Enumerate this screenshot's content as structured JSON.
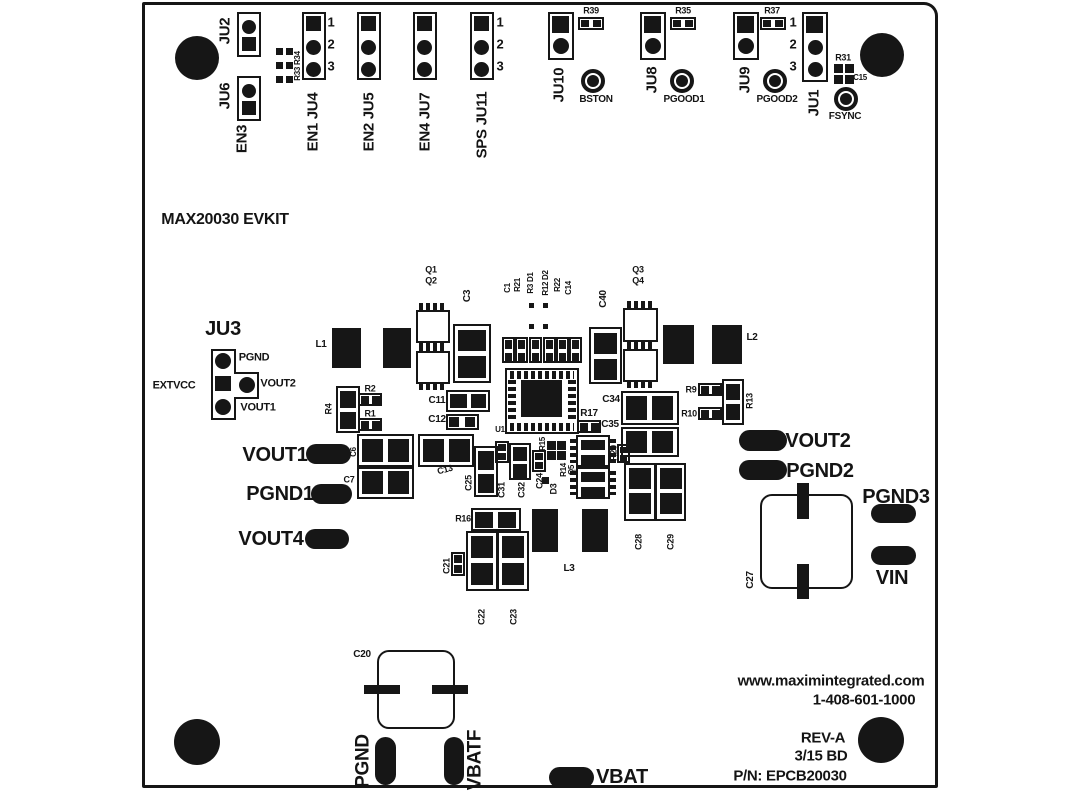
{
  "meta": {
    "title": "MAX20030 EVKIT",
    "part_number": "EPCB20030",
    "revision": "REV-A",
    "silkscreen_color": "#161616",
    "board_color": "#ffffff"
  },
  "labels": [
    {
      "n": "label-ju2",
      "t": "JU2",
      "x": 225,
      "y": 31,
      "s": 15,
      "r": -90
    },
    {
      "n": "label-ju6",
      "t": "JU6",
      "x": 225,
      "y": 96,
      "s": 15,
      "r": -90
    },
    {
      "n": "label-en3",
      "t": "EN3",
      "x": 242,
      "y": 139,
      "s": 15,
      "r": -90
    },
    {
      "n": "label-r33-r34",
      "t": "R33 R34",
      "x": 298,
      "y": 66,
      "s": 8,
      "r": -90
    },
    {
      "n": "label-ju4",
      "t": "EN1 JU4",
      "x": 313,
      "y": 122,
      "s": 15,
      "r": -90
    },
    {
      "n": "label-ju5",
      "t": "EN2 JU5",
      "x": 369,
      "y": 122,
      "s": 15,
      "r": -90
    },
    {
      "n": "label-ju7",
      "t": "EN4 JU7",
      "x": 425,
      "y": 122,
      "s": 15,
      "r": -90
    },
    {
      "n": "label-ju11",
      "t": "SPS JU11",
      "x": 482,
      "y": 125,
      "s": 15,
      "r": -90
    },
    {
      "n": "label-ju4-pin1",
      "t": "1",
      "x": 331,
      "y": 22,
      "s": 13
    },
    {
      "n": "label-ju4-pin2",
      "t": "2",
      "x": 331,
      "y": 44,
      "s": 13
    },
    {
      "n": "label-ju4-pin3",
      "t": "3",
      "x": 331,
      "y": 66,
      "s": 13
    },
    {
      "n": "label-ju11-pin1",
      "t": "1",
      "x": 500,
      "y": 22,
      "s": 13
    },
    {
      "n": "label-ju11-pin2",
      "t": "2",
      "x": 500,
      "y": 44,
      "s": 13
    },
    {
      "n": "label-ju11-pin3",
      "t": "3",
      "x": 500,
      "y": 66,
      "s": 13
    },
    {
      "n": "label-ju10",
      "t": "JU10",
      "x": 559,
      "y": 85,
      "s": 15,
      "r": -90
    },
    {
      "n": "label-r39",
      "t": "R39",
      "x": 591,
      "y": 11,
      "s": 9
    },
    {
      "n": "label-bston",
      "t": "BSTON",
      "x": 596,
      "y": 100,
      "s": 10
    },
    {
      "n": "label-ju8",
      "t": "JU8",
      "x": 652,
      "y": 80,
      "s": 15,
      "r": -90
    },
    {
      "n": "label-r35",
      "t": "R35",
      "x": 683,
      "y": 11,
      "s": 9
    },
    {
      "n": "label-pgood1",
      "t": "PGOOD1",
      "x": 684,
      "y": 100,
      "s": 10
    },
    {
      "n": "label-ju9",
      "t": "JU9",
      "x": 745,
      "y": 80,
      "s": 15,
      "r": -90
    },
    {
      "n": "label-r37",
      "t": "R37",
      "x": 772,
      "y": 11,
      "s": 9
    },
    {
      "n": "label-pgood2",
      "t": "PGOOD2",
      "x": 777,
      "y": 100,
      "s": 10
    },
    {
      "n": "label-ju1",
      "t": "JU1",
      "x": 814,
      "y": 103,
      "s": 15,
      "r": -90
    },
    {
      "n": "label-ju1-pin1",
      "t": "1",
      "x": 793,
      "y": 22,
      "s": 13
    },
    {
      "n": "label-ju1-pin2",
      "t": "2",
      "x": 793,
      "y": 44,
      "s": 13
    },
    {
      "n": "label-ju1-pin3",
      "t": "3",
      "x": 793,
      "y": 66,
      "s": 13
    },
    {
      "n": "label-r31",
      "t": "R31",
      "x": 843,
      "y": 58,
      "s": 9
    },
    {
      "n": "label-c15",
      "t": "C15",
      "x": 860,
      "y": 78,
      "s": 8
    },
    {
      "n": "label-fsync",
      "t": "FSYNC",
      "x": 845,
      "y": 117,
      "s": 10
    },
    {
      "n": "board-title",
      "t": "MAX20030 EVKIT",
      "x": 225,
      "y": 220,
      "s": 16
    },
    {
      "n": "label-ju3",
      "t": "JU3",
      "x": 223,
      "y": 329,
      "s": 20
    },
    {
      "n": "label-ju3-pgnd",
      "t": "PGND",
      "x": 254,
      "y": 358,
      "s": 11
    },
    {
      "n": "label-ju3-vout2",
      "t": "VOUT2",
      "x": 278,
      "y": 384,
      "s": 11
    },
    {
      "n": "label-ju3-vout1",
      "t": "VOUT1",
      "x": 258,
      "y": 408,
      "s": 11
    },
    {
      "n": "label-extvcc",
      "t": "EXTVCC",
      "x": 174,
      "y": 386,
      "s": 11
    },
    {
      "n": "label-l1",
      "t": "L1",
      "x": 321,
      "y": 345,
      "s": 10
    },
    {
      "n": "label-q1",
      "t": "Q1",
      "x": 431,
      "y": 270,
      "s": 9
    },
    {
      "n": "label-q2",
      "t": "Q2",
      "x": 431,
      "y": 281,
      "s": 9
    },
    {
      "n": "label-c3",
      "t": "C3",
      "x": 468,
      "y": 296,
      "s": 10,
      "r": -90
    },
    {
      "n": "label-c1",
      "t": "C1",
      "x": 508,
      "y": 288,
      "s": 8,
      "r": -90
    },
    {
      "n": "label-r21",
      "t": "R21",
      "x": 518,
      "y": 285,
      "s": 8,
      "r": -90
    },
    {
      "n": "label-r3-d1",
      "t": "R3 D1",
      "x": 531,
      "y": 283,
      "s": 8,
      "r": -90
    },
    {
      "n": "label-r12-d2",
      "t": "R12 D2",
      "x": 546,
      "y": 283,
      "s": 8,
      "r": -90
    },
    {
      "n": "label-r22",
      "t": "R22",
      "x": 558,
      "y": 285,
      "s": 8,
      "r": -90
    },
    {
      "n": "label-c14",
      "t": "C14",
      "x": 569,
      "y": 288,
      "s": 8,
      "r": -90
    },
    {
      "n": "label-q3",
      "t": "Q3",
      "x": 638,
      "y": 270,
      "s": 9
    },
    {
      "n": "label-q4",
      "t": "Q4",
      "x": 638,
      "y": 281,
      "s": 9
    },
    {
      "n": "label-c40",
      "t": "C40",
      "x": 604,
      "y": 299,
      "s": 10,
      "r": -90
    },
    {
      "n": "label-l2",
      "t": "L2",
      "x": 752,
      "y": 338,
      "s": 10
    },
    {
      "n": "label-r9",
      "t": "R9",
      "x": 691,
      "y": 390,
      "s": 9
    },
    {
      "n": "label-r10",
      "t": "R10",
      "x": 689,
      "y": 414,
      "s": 9
    },
    {
      "n": "label-r13",
      "t": "R13",
      "x": 750,
      "y": 401,
      "s": 9,
      "r": -90
    },
    {
      "n": "label-c34",
      "t": "C34",
      "x": 611,
      "y": 400,
      "s": 10
    },
    {
      "n": "label-c35",
      "t": "C35",
      "x": 610,
      "y": 425,
      "s": 10
    },
    {
      "n": "label-r17",
      "t": "R17",
      "x": 589,
      "y": 414,
      "s": 10
    },
    {
      "n": "label-r4",
      "t": "R4",
      "x": 329,
      "y": 409,
      "s": 9,
      "r": -90
    },
    {
      "n": "label-r2",
      "t": "R2",
      "x": 370,
      "y": 389,
      "s": 9
    },
    {
      "n": "label-r1",
      "t": "R1",
      "x": 370,
      "y": 414,
      "s": 9
    },
    {
      "n": "label-c11",
      "t": "C11",
      "x": 437,
      "y": 401,
      "s": 10
    },
    {
      "n": "label-c12",
      "t": "C12",
      "x": 437,
      "y": 420,
      "s": 10
    },
    {
      "n": "label-u1",
      "t": "U1",
      "x": 500,
      "y": 430,
      "s": 8
    },
    {
      "n": "label-vout1",
      "t": "VOUT1",
      "x": 275,
      "y": 455,
      "s": 20
    },
    {
      "n": "label-c6",
      "t": "C6",
      "x": 354,
      "y": 452,
      "s": 8,
      "r": -90
    },
    {
      "n": "label-c7",
      "t": "C7",
      "x": 349,
      "y": 480,
      "s": 9
    },
    {
      "n": "label-c13",
      "t": "C13",
      "x": 445,
      "y": 470,
      "s": 9,
      "r": -15
    },
    {
      "n": "label-pgnd1",
      "t": "PGND1",
      "x": 280,
      "y": 494,
      "s": 20
    },
    {
      "n": "label-vout4",
      "t": "VOUT4",
      "x": 271,
      "y": 539,
      "s": 20
    },
    {
      "n": "label-c25",
      "t": "C25",
      "x": 469,
      "y": 483,
      "s": 9,
      "r": -90
    },
    {
      "n": "label-c31",
      "t": "C31",
      "x": 502,
      "y": 490,
      "s": 9,
      "r": -90
    },
    {
      "n": "label-c32",
      "t": "C32",
      "x": 522,
      "y": 490,
      "s": 9,
      "r": -90
    },
    {
      "n": "label-c24",
      "t": "C24",
      "x": 540,
      "y": 481,
      "s": 9,
      "r": -90
    },
    {
      "n": "label-r15",
      "t": "R15",
      "x": 543,
      "y": 444,
      "s": 8,
      "r": -90
    },
    {
      "n": "label-d3",
      "t": "D3",
      "x": 554,
      "y": 489,
      "s": 9,
      "r": -90
    },
    {
      "n": "label-r14",
      "t": "R14",
      "x": 564,
      "y": 470,
      "s": 8,
      "r": -90
    },
    {
      "n": "label-q5",
      "t": "Q5",
      "x": 572,
      "y": 470,
      "s": 8,
      "r": -90
    },
    {
      "n": "label-r20",
      "t": "R20",
      "x": 614,
      "y": 453,
      "s": 9,
      "r": -90
    },
    {
      "n": "label-r16",
      "t": "R16",
      "x": 463,
      "y": 519,
      "s": 9
    },
    {
      "n": "label-c21",
      "t": "C21",
      "x": 447,
      "y": 566,
      "s": 9,
      "r": -90
    },
    {
      "n": "label-c22",
      "t": "C22",
      "x": 482,
      "y": 617,
      "s": 9,
      "r": -90
    },
    {
      "n": "label-c23",
      "t": "C23",
      "x": 514,
      "y": 617,
      "s": 9,
      "r": -90
    },
    {
      "n": "label-l3",
      "t": "L3",
      "x": 569,
      "y": 569,
      "s": 10
    },
    {
      "n": "label-c28",
      "t": "C28",
      "x": 639,
      "y": 542,
      "s": 9,
      "r": -90
    },
    {
      "n": "label-c29",
      "t": "C29",
      "x": 671,
      "y": 542,
      "s": 9,
      "r": -90
    },
    {
      "n": "label-vout2",
      "t": "VOUT2",
      "x": 818,
      "y": 441,
      "s": 20
    },
    {
      "n": "label-pgnd2",
      "t": "PGND2",
      "x": 820,
      "y": 471,
      "s": 20
    },
    {
      "n": "label-c27",
      "t": "C27",
      "x": 751,
      "y": 580,
      "s": 10,
      "r": -90
    },
    {
      "n": "label-pgnd3",
      "t": "PGND3",
      "x": 896,
      "y": 497,
      "s": 20
    },
    {
      "n": "label-vin",
      "t": "VIN",
      "x": 892,
      "y": 578,
      "s": 20
    },
    {
      "n": "label-c20",
      "t": "C20",
      "x": 362,
      "y": 655,
      "s": 10
    },
    {
      "n": "label-pgnd",
      "t": "PGND",
      "x": 363,
      "y": 761,
      "s": 19,
      "r": -90
    },
    {
      "n": "label-vbatf",
      "t": "VBATF",
      "x": 475,
      "y": 760,
      "s": 19,
      "r": -90
    },
    {
      "n": "label-vbat",
      "t": "VBAT",
      "x": 622,
      "y": 777,
      "s": 20
    },
    {
      "n": "label-website",
      "t": "www.maximintegrated.com",
      "x": 831,
      "y": 681,
      "s": 15
    },
    {
      "n": "label-phone",
      "t": "1-408-601-1000",
      "x": 864,
      "y": 700,
      "s": 15
    },
    {
      "n": "label-rev",
      "t": "REV-A",
      "x": 823,
      "y": 738,
      "s": 15
    },
    {
      "n": "label-rev-date",
      "t": "3/15 BD",
      "x": 821,
      "y": 756,
      "s": 15
    },
    {
      "n": "label-part-number",
      "t": "P/N: EPCB20030",
      "x": 790,
      "y": 776,
      "s": 15
    }
  ]
}
